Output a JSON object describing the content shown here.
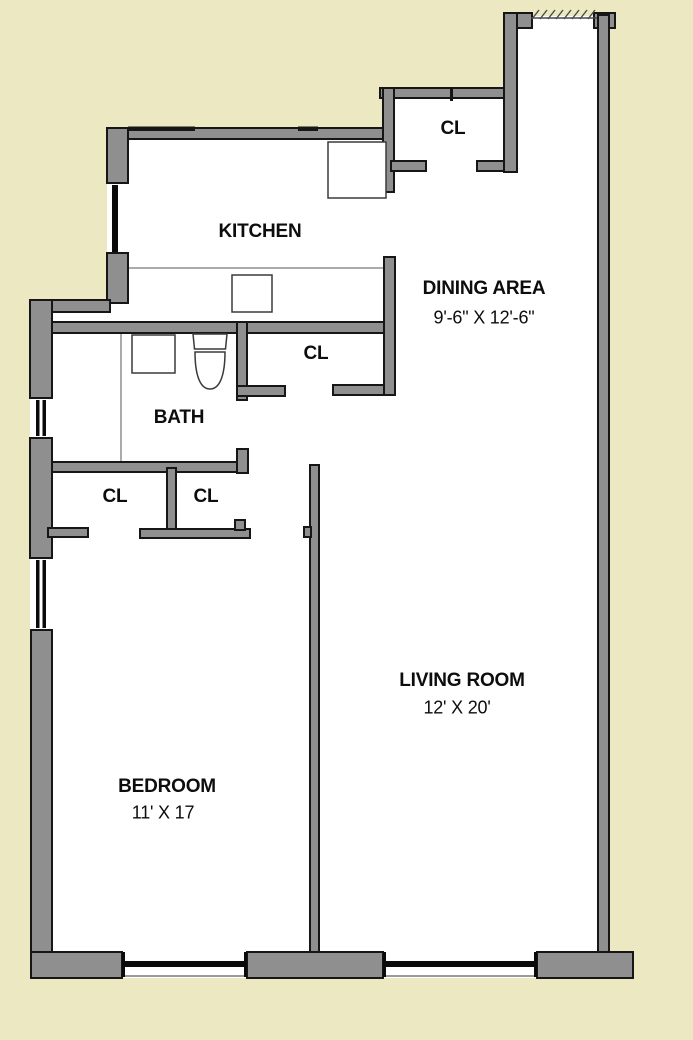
{
  "colors": {
    "background": "#EBE8C2",
    "wall_fill": "#8F8F8F",
    "wall_outline": "#161616",
    "floor": "#FFFFFF"
  },
  "rooms": {
    "kitchen": {
      "label": "KITCHEN"
    },
    "dining": {
      "label": "DINING AREA",
      "dimensions": "9'-6\" X 12'-6\""
    },
    "bath": {
      "label": "BATH"
    },
    "bedroom": {
      "label": "BEDROOM",
      "dimensions": "11' X 17"
    },
    "living": {
      "label": "LIVING ROOM",
      "dimensions": "12' X 20'"
    }
  },
  "closets": [
    {
      "label": "CL"
    },
    {
      "label": "CL"
    },
    {
      "label": "CL"
    },
    {
      "label": "CL"
    }
  ]
}
